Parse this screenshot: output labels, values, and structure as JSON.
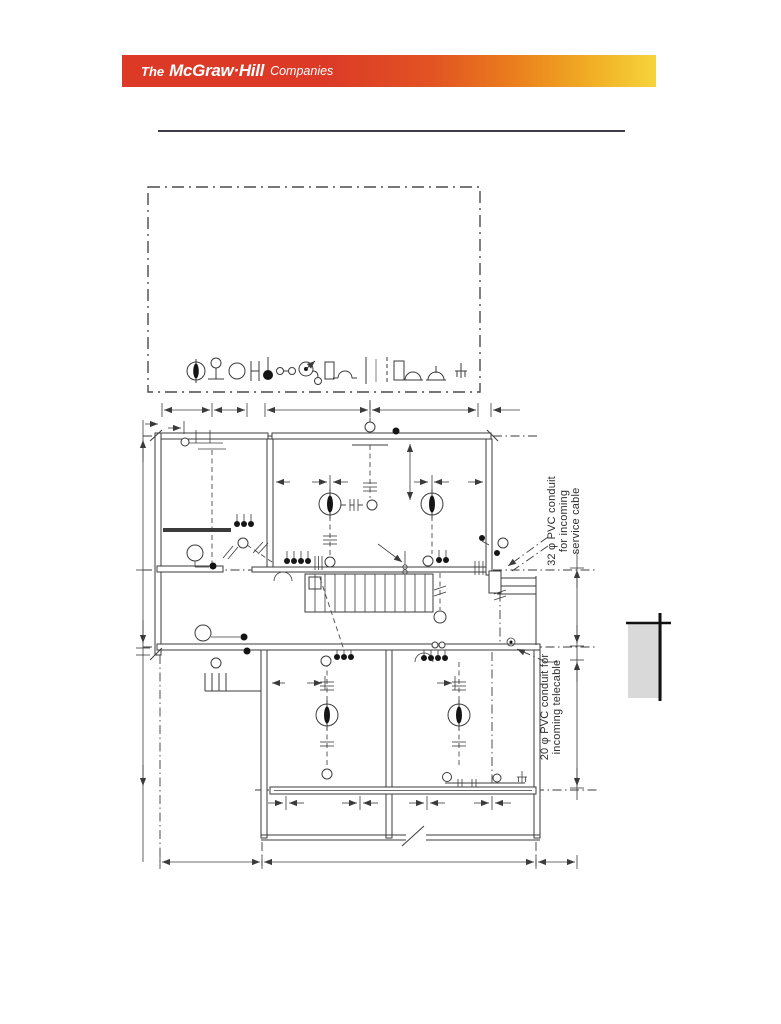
{
  "page": {
    "background": "#ffffff"
  },
  "banner": {
    "text_prefix": "The",
    "text_brand": "McGraw·Hill",
    "text_suffix": "Companies",
    "colors": {
      "start": "#dc3a27",
      "mid": "#ea7d1e",
      "end": "#f6d43b",
      "text": "#ffffff"
    }
  },
  "divider": {
    "color": "#3d3d45"
  },
  "figure": {
    "kind": "electrical-installation floor plan with symbol legend",
    "line_color": "#3b3b3b",
    "legend": {
      "symbols": [
        "ceiling-luminaire",
        "pendant-luminaire",
        "lamp-outlet",
        "fluorescent-fitting",
        "push-button",
        "linked-outlets",
        "switch-with-pilot-lamp",
        "distribution-board",
        "bell",
        "conduit-run",
        "conduit-run-thin",
        "concealed-conduit-run",
        "panel-box",
        "buzzer",
        "indicator",
        "earth-connection"
      ]
    },
    "annotations": [
      {
        "id": "service-conduit",
        "lines": [
          "32 φ PVC conduit",
          "for incoming",
          "service cable"
        ]
      },
      {
        "id": "telecable-conduit",
        "lines": [
          "20 φ PVC conduit for",
          "incoming telecable"
        ]
      }
    ]
  },
  "side_tab": {
    "fill": "#d9d9d9",
    "line_color": "#111111"
  }
}
